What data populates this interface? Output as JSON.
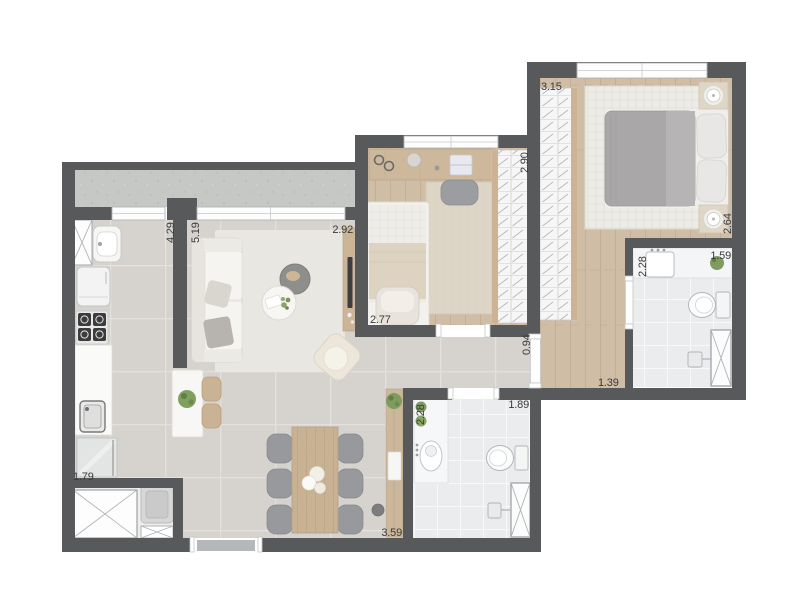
{
  "plan": {
    "type": "apartment-floor-plan",
    "colors": {
      "wall": "#58595b",
      "wood_floor": "#cfbda6",
      "tile_floor": "#d6d3ce",
      "bath_tile": "#eaecee",
      "terrace_concrete": "#c6c8c6",
      "plant_green": "#7e9c5f",
      "label_text": "#3a3a3c"
    },
    "measurements": {
      "master_bedroom_width": "3.15",
      "master_bedroom_depth": "2.64",
      "bedroom2_depth": "2.90",
      "bedroom2_width": "2.77",
      "living_width": "2.92",
      "living_depth": "5.19",
      "kitchen_depth": "4.29",
      "kitchen_width": "1.79",
      "hall_passage": "0.94",
      "corridor_width": "1.39",
      "ensuite_depth": "2.28",
      "ensuite_width": "1.59",
      "bathroom_depth": "2.28",
      "bathroom_width": "1.89",
      "dining_width": "3.59"
    }
  }
}
